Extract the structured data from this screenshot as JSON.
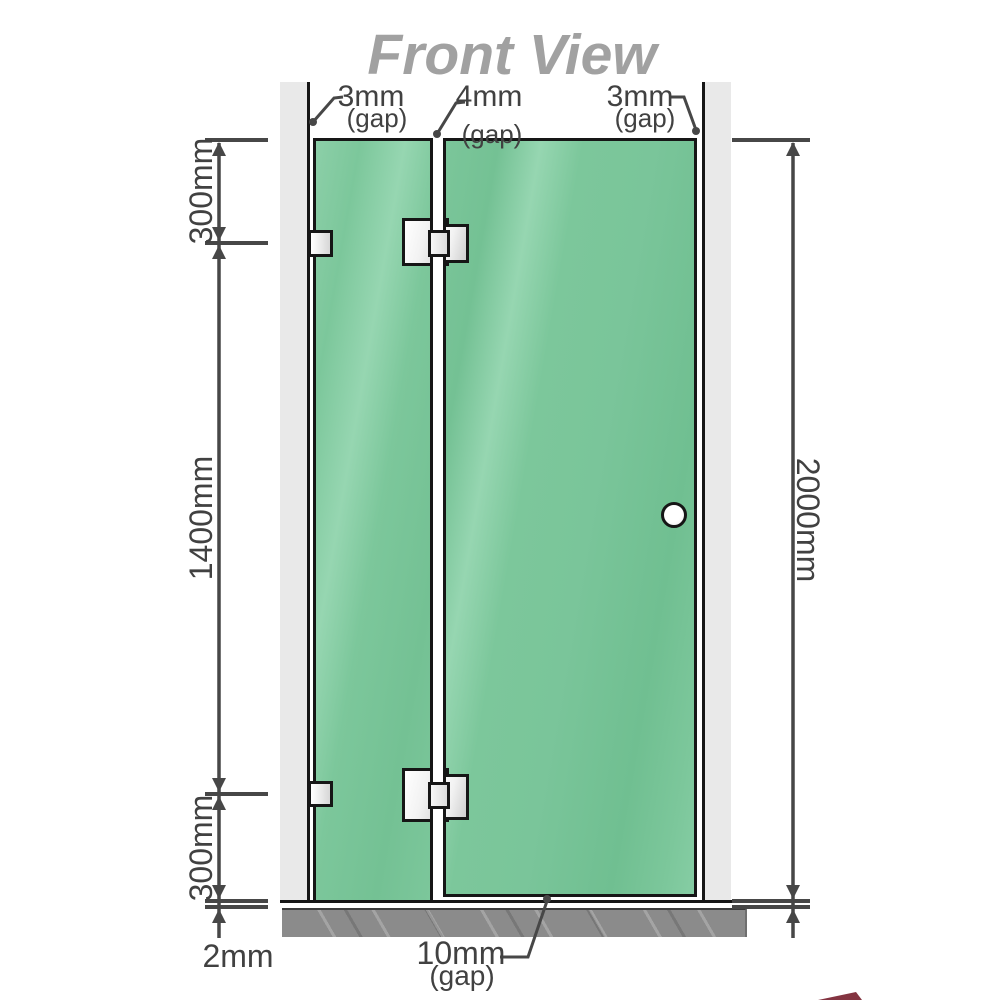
{
  "title": "Front View",
  "measurements": {
    "top_gap_left": {
      "value": "3mm",
      "note": "(gap)"
    },
    "top_gap_middle": {
      "value": "4mm",
      "note": "(gap)"
    },
    "top_gap_right": {
      "value": "3mm",
      "note": "(gap)"
    },
    "bottom_door_gap": {
      "value": "10mm",
      "note": "(gap)"
    },
    "left_top_segment": "300mm",
    "left_middle_segment": "1400mm",
    "left_bottom_segment": "300mm",
    "right_total_height": "2000mm",
    "bottom_floor_gap": "2mm"
  },
  "colors": {
    "glass_green": "#7cc79b",
    "wall_gray": "#e9e9e9",
    "floor_gray": "#8b8b8b",
    "line_dark": "#474747",
    "outline_black": "#161616",
    "title_gray": "#a1a1a1",
    "label_dark": "#414141"
  }
}
